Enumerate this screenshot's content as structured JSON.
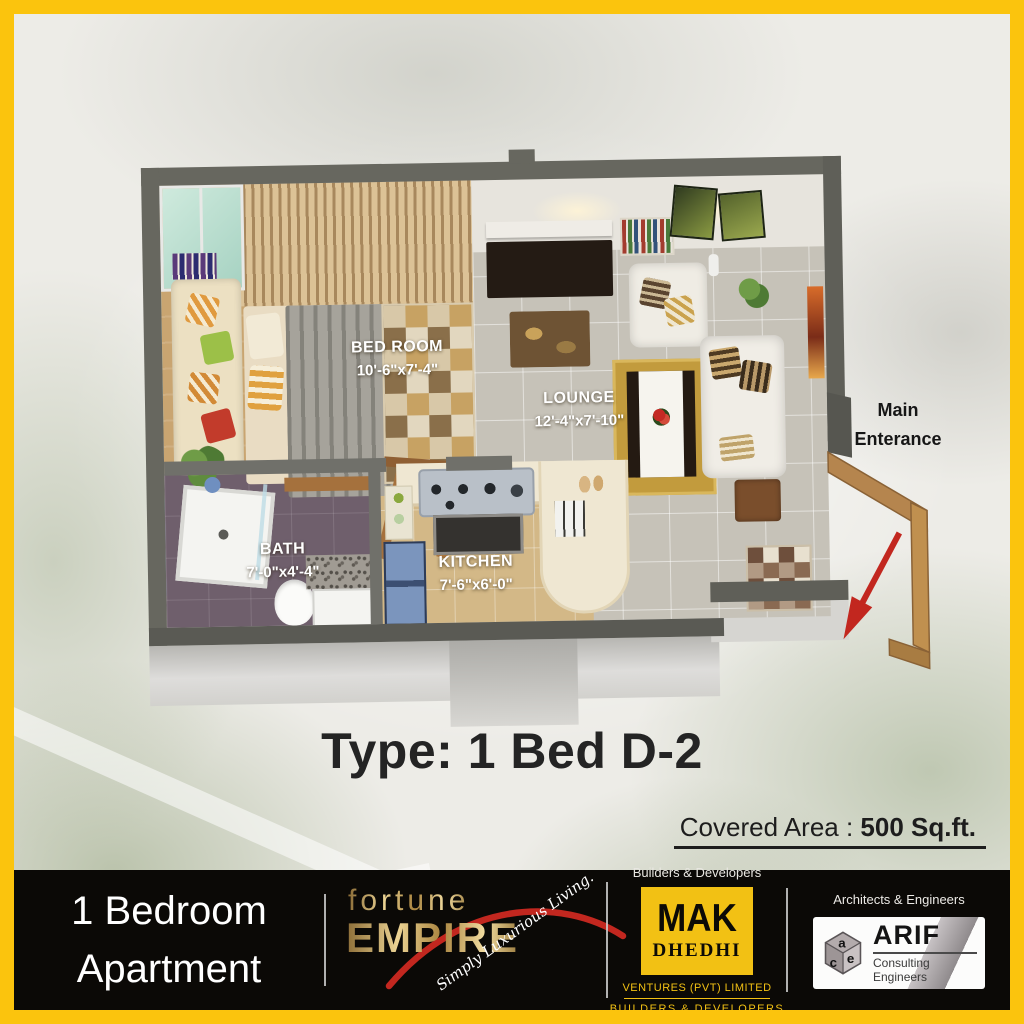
{
  "colors": {
    "frame_yellow": "#FBC40D",
    "footer_black": "#0B0906",
    "brand_gold": "#D8B267",
    "mak_yellow": "#F2C114",
    "accent_red": "#C2271F",
    "wall_gray": "#67675F"
  },
  "plan": {
    "rooms": [
      {
        "name": "BED ROOM",
        "dims": "10'-6\"x7'-4\""
      },
      {
        "name": "LOUNGE",
        "dims": "12'-4\"x7'-10\""
      },
      {
        "name": "BATH",
        "dims": "7'-0\"x4'-4\""
      },
      {
        "name": "KITCHEN",
        "dims": "7'-6\"x6'-0\""
      }
    ],
    "entrance": {
      "line1": "Main",
      "line2": "Enterance"
    }
  },
  "title": "Type: 1 Bed D-2",
  "covered_area": {
    "label": "Covered Area : ",
    "value": "500 Sq.ft."
  },
  "footer": {
    "unit_line1": "1 Bedroom",
    "unit_line2": "Apartment",
    "fortune_line1": "fortune",
    "fortune_line2": "EMPIRE",
    "fortune_tagline": "Simply Luxurious Living.",
    "mak_top": "Builders & Developers",
    "mak_name_top": "MAK",
    "mak_name_bottom": "DHEDHI",
    "mak_sub1": "VENTURES (PVT) LIMITED",
    "mak_sub2": "BUILDERS & DEVELOPERS",
    "arif_top": "Architects & Engineers",
    "arif_cube_a": "a",
    "arif_cube_e": "e",
    "arif_cube_c": "c",
    "arif_name": "ARIF",
    "arif_sub": "Consulting Engineers"
  }
}
